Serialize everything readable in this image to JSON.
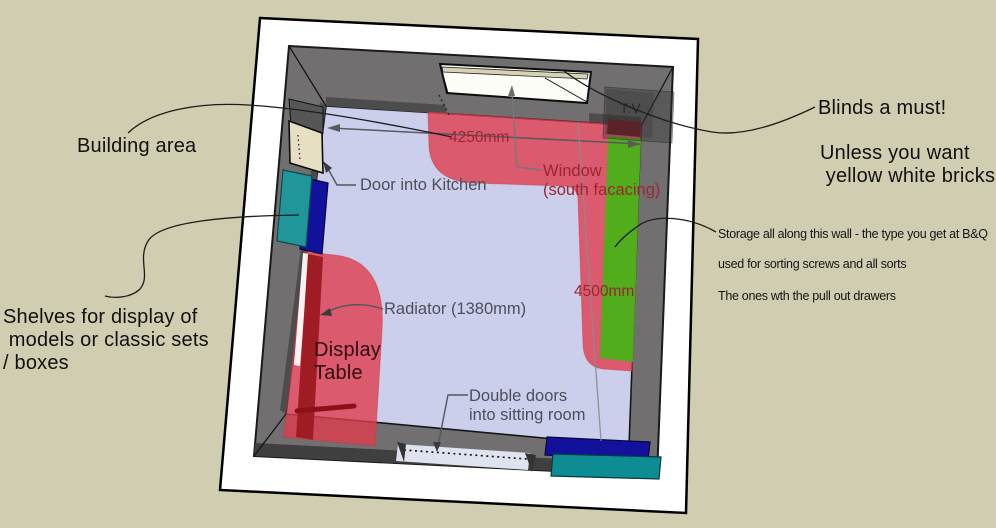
{
  "scene_title": "Room floor plan sketch with annotations",
  "colors": {
    "background": "#d0cdb0",
    "paper": "#ffffff",
    "wall": "#716f6f",
    "wall_shadow": "#4d4c4c",
    "floor": "#cbcfec",
    "zone_red": "#e03c4e",
    "radiator_red": "#a01c24",
    "storage_green": "#46b415",
    "shelf_teal": "#20969b",
    "shelf_navy": "#11119b",
    "door_beige": "#e6dfc2",
    "label_red": "#9c2531",
    "label_gray": "#4e4e5a"
  },
  "labels": {
    "building_area": "Building area",
    "door_kitchen": "Door into Kitchen",
    "shelves": "Shelves for display of\n models or classic sets\n/ boxes",
    "display_table": "Display\nTable",
    "radiator": "Radiator (1380mm)",
    "double_doors": "Double doors\ninto sitting room",
    "window": "Window\n(south facacing)",
    "dim_width": "4250mm",
    "dim_height": "4500mm",
    "tv": "T.V",
    "blinds": "Blinds a must!",
    "unless": "Unless you want\n yellow white bricks",
    "storage_line1": "Storage all along this wall - the type you get at B&Q",
    "storage_line2": "used for sorting screws and all sorts",
    "storage_line3": "The ones wth the pull out drawers"
  }
}
